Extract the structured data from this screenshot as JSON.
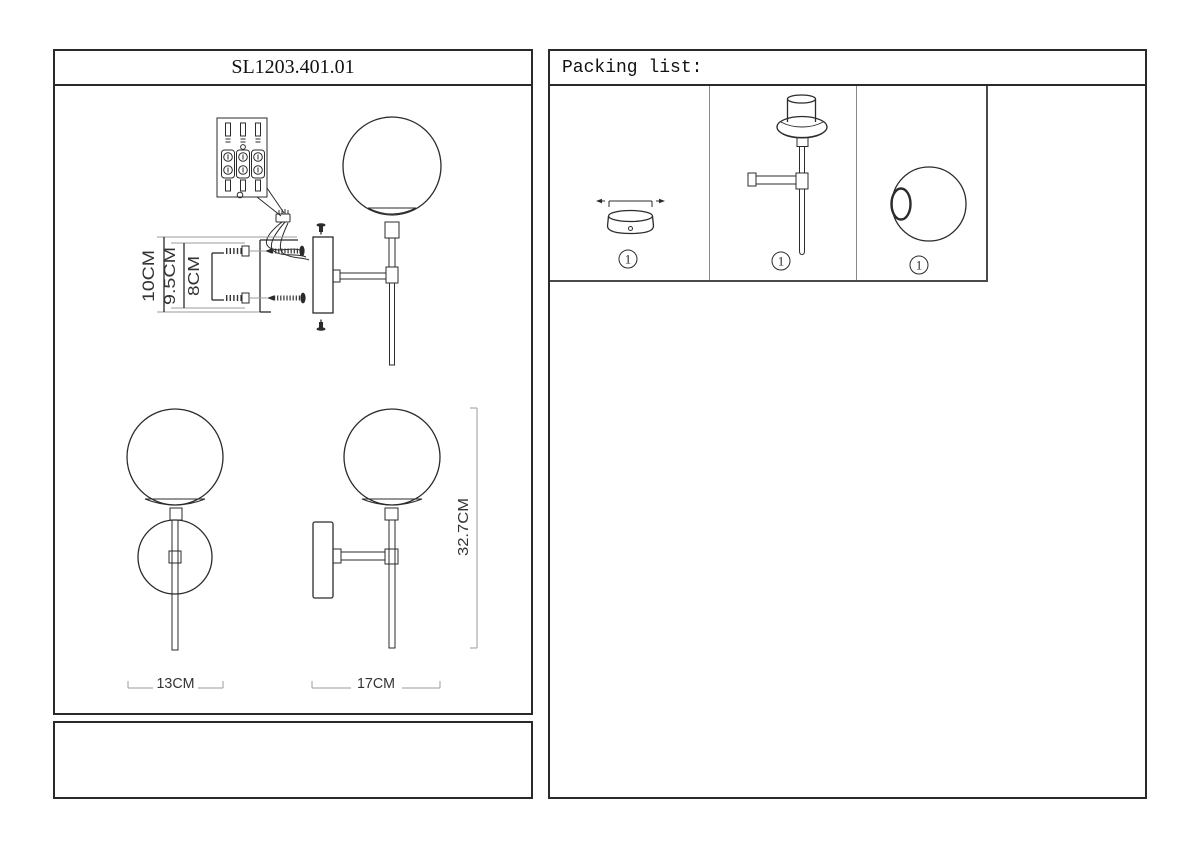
{
  "left_panel": {
    "title": "SL1203.401.01",
    "install_view": {
      "dim_outer": "10CM",
      "dim_mid": "9.5CM",
      "dim_inner": "8CM"
    },
    "front_view": {
      "dim_width": "13CM"
    },
    "side_view": {
      "dim_depth": "17CM",
      "dim_height": "32.7CM"
    }
  },
  "packing_list": {
    "title": "Packing list:",
    "items": [
      {
        "name": "wall-canopy",
        "icon": "canopy-side-view",
        "qty": "1"
      },
      {
        "name": "lamp-body",
        "icon": "lamp-body-with-arm",
        "qty": "1"
      },
      {
        "name": "glass-globe",
        "icon": "globe-with-opening",
        "qty": "1"
      }
    ]
  },
  "colors": {
    "line": "#2b2b2b",
    "line_light": "#9b9b9b",
    "divider": "#8a8a8a",
    "bg": "#ffffff"
  }
}
